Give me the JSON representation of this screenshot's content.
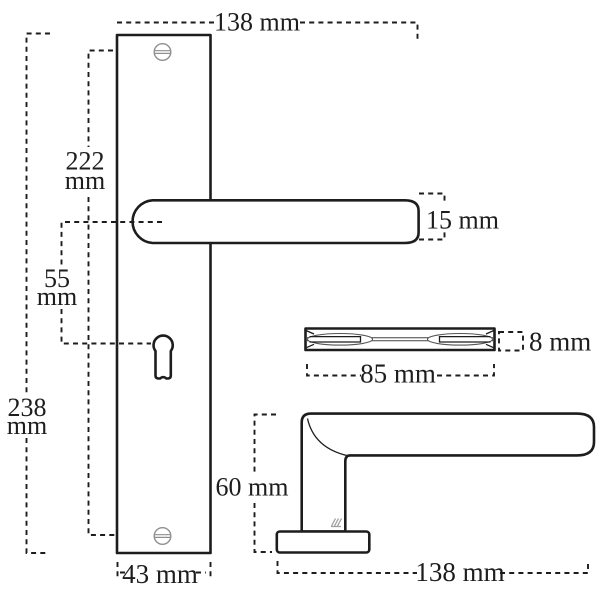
{
  "drawing": {
    "colors": {
      "line": "#1d1d1d",
      "screw": "#8f8f8f",
      "stamp": "#a0a0a0",
      "background": "#ffffff"
    },
    "dimensions": {
      "plate_top_width": {
        "text": "138 mm"
      },
      "screw_distance": {
        "value": "222",
        "unit": "mm"
      },
      "handle_to_keyhole": {
        "value": "55",
        "unit": "mm"
      },
      "plate_height": {
        "value": "238",
        "unit": "mm"
      },
      "lever_thickness": {
        "text": "15 mm"
      },
      "spindle_thickness": {
        "text": "8 mm"
      },
      "spindle_length": {
        "text": "85 mm"
      },
      "handle_height": {
        "text": "60 mm"
      },
      "handle_length": {
        "text": "138 mm"
      },
      "plate_width": {
        "text": "43 mm"
      }
    }
  }
}
